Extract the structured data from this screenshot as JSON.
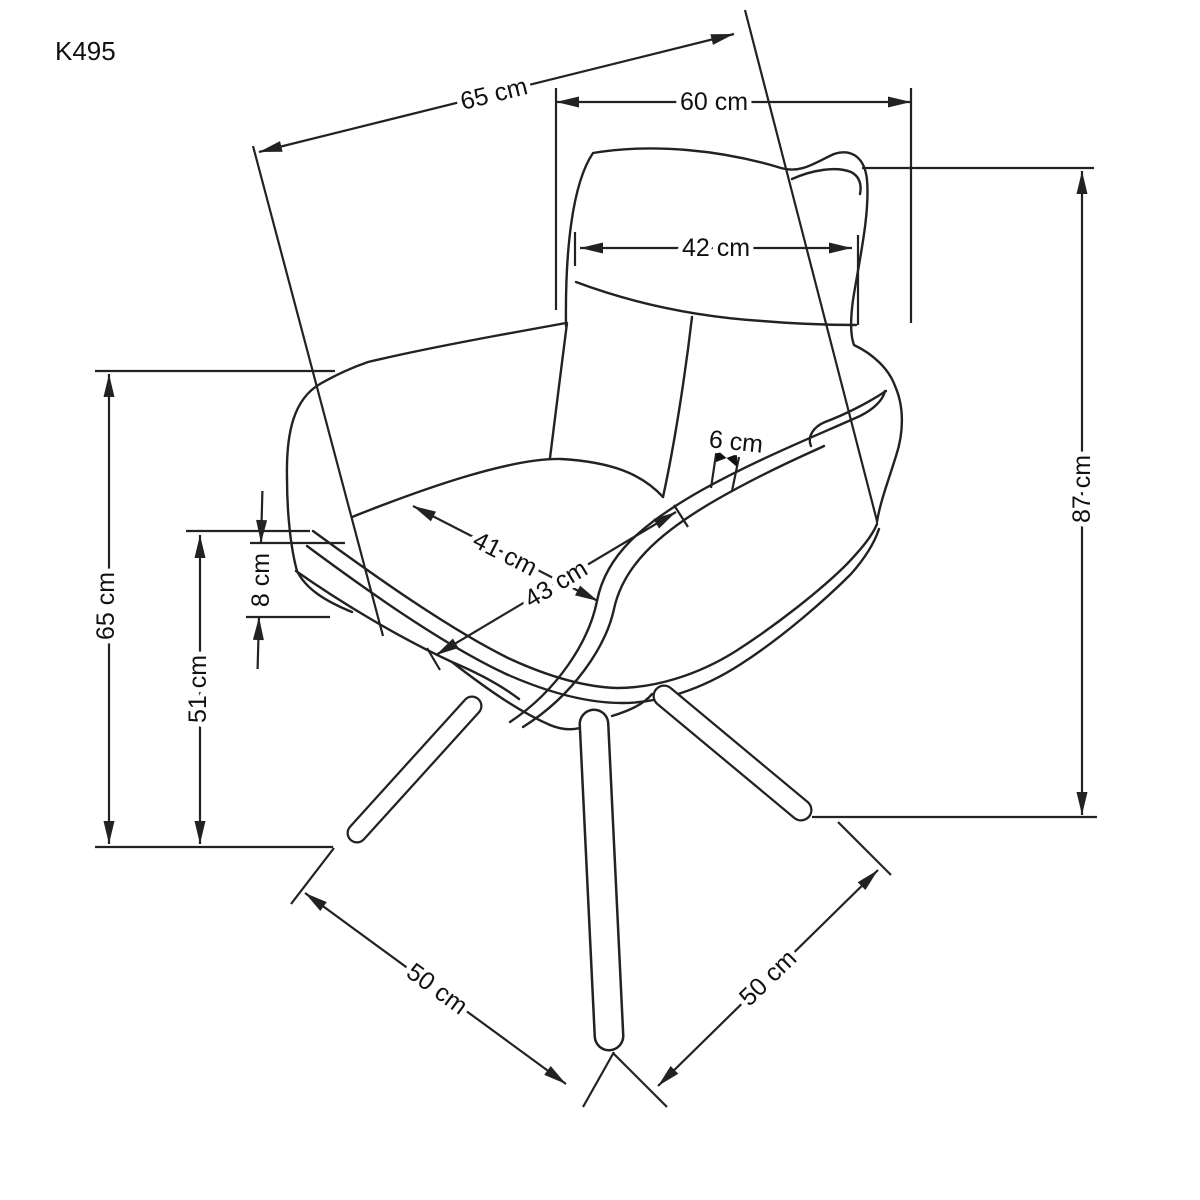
{
  "page": {
    "background": "#ffffff",
    "line_color": "#222222",
    "label_color": "#111111"
  },
  "title_label": "K495",
  "units": "cm",
  "dimensions": [
    {
      "id": "total-depth",
      "label": "65 cm",
      "line": [
        259,
        152,
        734,
        34
      ],
      "arrows": "inside",
      "ext": [
        [
          253,
          146,
          383,
          636
        ],
        [
          745,
          10,
          877,
          521
        ]
      ],
      "label_pos": [
        494,
        94
      ],
      "label_rotation": -14
    },
    {
      "id": "total-width",
      "label": "60 cm",
      "line": [
        556,
        102,
        911,
        102
      ],
      "arrows": "inside",
      "ext": [
        [
          556,
          88,
          556,
          310
        ],
        [
          911,
          88,
          911,
          323
        ]
      ],
      "label_pos": [
        714,
        102
      ],
      "label_rotation": 0
    },
    {
      "id": "backrest-width",
      "label": "42 cm",
      "line": [
        580,
        248,
        852,
        248
      ],
      "arrows": "inside",
      "ext": [
        [
          575,
          232,
          575,
          266
        ],
        [
          858,
          235,
          858,
          325
        ]
      ],
      "label_pos": [
        716,
        248
      ],
      "label_rotation": 0
    },
    {
      "id": "total-height",
      "label": "87 cm",
      "line": [
        1082,
        171,
        1082,
        815
      ],
      "arrows": "inside",
      "ext": [
        [
          862,
          168,
          1094,
          168
        ],
        [
          812,
          817,
          1097,
          817
        ]
      ],
      "label_pos": [
        1082,
        489
      ],
      "label_rotation": -90
    },
    {
      "id": "armrest-height",
      "label": "65 cm",
      "line": [
        109,
        374,
        109,
        844
      ],
      "arrows": "inside",
      "ext": [
        [
          95,
          371,
          335,
          371
        ],
        [
          95,
          847,
          333,
          847
        ]
      ],
      "label_pos": [
        106,
        606
      ],
      "label_rotation": -90
    },
    {
      "id": "seat-height",
      "label": "51 cm",
      "line": [
        200,
        535,
        200,
        844
      ],
      "arrows": "inside",
      "ext": [
        [
          186,
          531,
          310,
          531
        ]
      ],
      "label_pos": [
        198,
        689
      ],
      "label_rotation": -90
    },
    {
      "id": "cushion-thickness",
      "label": "8 cm",
      "line": [
        261,
        543,
        259,
        617
      ],
      "arrows": "outside",
      "shaft_len": 52,
      "ext": [
        [
          250,
          543,
          345,
          543
        ],
        [
          246,
          617,
          330,
          617
        ]
      ],
      "label_pos": [
        261,
        580
      ],
      "label_rotation": -90
    },
    {
      "id": "seat-width",
      "label": "41 cm",
      "line": [
        413,
        506,
        598,
        601
      ],
      "arrows": "inside",
      "ext": [],
      "label_pos": [
        505,
        554
      ],
      "label_rotation": 27
    },
    {
      "id": "seat-depth",
      "label": "43 cm",
      "line": [
        436,
        655,
        676,
        512
      ],
      "arrows": "inside",
      "ext": [
        [
          427,
          648,
          440,
          670
        ],
        [
          674,
          505,
          688,
          527
        ]
      ],
      "label_pos": [
        556,
        584
      ],
      "label_rotation": -31
    },
    {
      "id": "base-span-left",
      "label": "50 cm",
      "line": [
        305,
        893,
        566,
        1084
      ],
      "arrows": "inside",
      "ext": [
        [
          291,
          904,
          334,
          848
        ],
        [
          583,
          1107,
          614,
          1052
        ]
      ],
      "label_pos": [
        437,
        989
      ],
      "label_rotation": 36
    },
    {
      "id": "base-span-right",
      "label": "50 cm",
      "line": [
        658,
        1086,
        878,
        870
      ],
      "arrows": "inside",
      "ext": [
        [
          613,
          1053,
          667,
          1107
        ],
        [
          838,
          822,
          891,
          875
        ]
      ],
      "label_pos": [
        768,
        978
      ],
      "label_rotation": -44
    },
    {
      "id": "seat-edge-thickness",
      "label": "6 cm",
      "arrows": "none",
      "ext": [
        [
          718,
          441,
          711,
          488
        ],
        [
          739,
          457,
          732,
          491
        ]
      ],
      "bowtie": {
        "left": [
          716,
          449
        ],
        "right": [
          737,
          454
        ],
        "h": 13
      },
      "label_pos": [
        736,
        442
      ],
      "label_rotation": 6
    }
  ]
}
